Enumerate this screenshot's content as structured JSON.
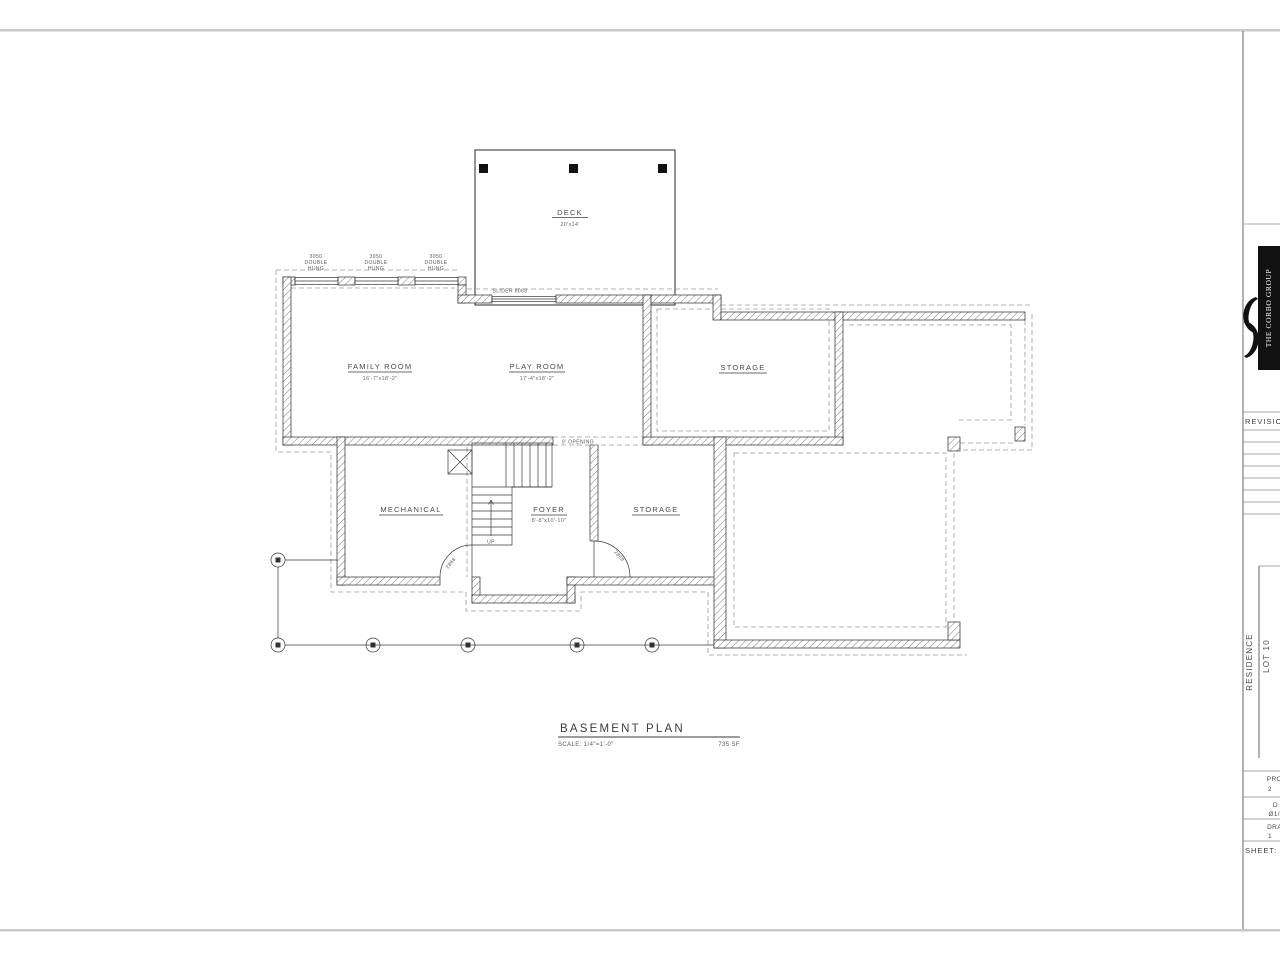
{
  "plan": {
    "deck": {
      "label": "DECK",
      "dim": "20'x14'"
    },
    "family_room": {
      "label": "FAMILY ROOM",
      "dim": "16'-7\"x18'-2\""
    },
    "play_room": {
      "label": "PLAY ROOM",
      "dim": "17'-4\"x18'-2\""
    },
    "storage_upper": {
      "label": "STORAGE"
    },
    "mechanical": {
      "label": "MECHANICAL"
    },
    "foyer": {
      "label": "FOYER",
      "dim": "8'-8\"x10'-10\""
    },
    "storage_lower": {
      "label": "STORAGE"
    },
    "stairs_up": "UP",
    "opening": "9' OPENING",
    "slider": "SLIDER 8068",
    "window": {
      "l1": "3050",
      "l2": "DOUBLE",
      "l3": "HUNG"
    },
    "door_size": "2868"
  },
  "title": {
    "name": "BASEMENT PLAN",
    "scale": "SCALE: 1/4\"=1'-0\"",
    "area": "735 SF"
  },
  "titleblock": {
    "logo": "THE CORBO GROUP",
    "revisions": "REVISIONS",
    "residence": "RESIDENCE",
    "lot": "LOT 10",
    "project_label": "PRO",
    "project_value": "2",
    "date_label": "D",
    "date_value": "Ø1/",
    "drawn_label": "DRA",
    "drawn_value": "1",
    "sheet_label": "SHEET:"
  }
}
